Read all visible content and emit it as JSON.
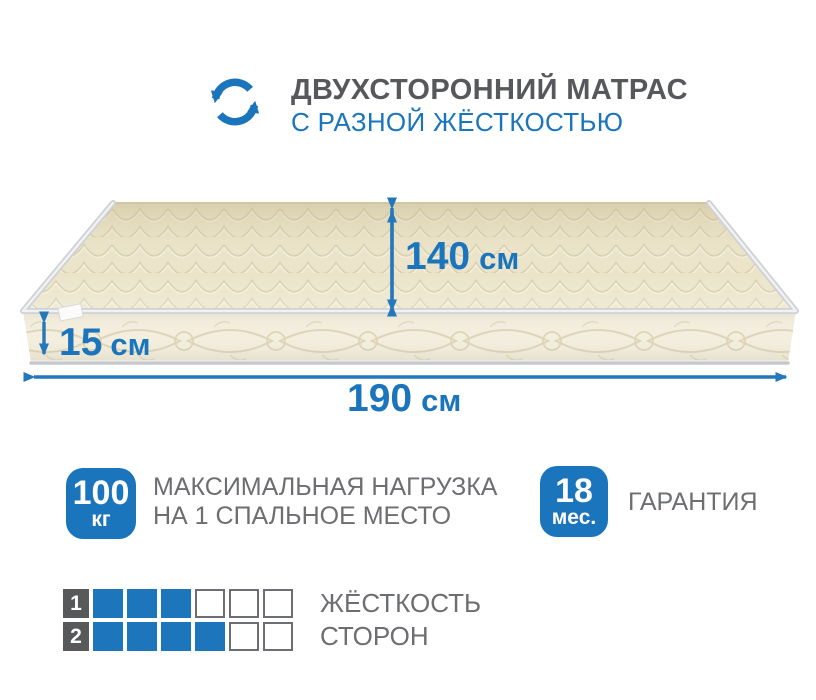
{
  "header": {
    "icon": "rotate-arrows-icon",
    "title_line1": "ДВУХСТОРОННИЙ МАТРАС",
    "title_line2": "С РАЗНОЙ ЖЁСТКОСТЬЮ"
  },
  "mattress": {
    "depth": {
      "value": "140",
      "unit": "см"
    },
    "height": {
      "value": "15",
      "unit": "см"
    },
    "length": {
      "value": "190",
      "unit": "см"
    }
  },
  "badges": {
    "max_load": {
      "value": "100",
      "unit": "кг",
      "line1": "МАКСИМАЛЬНАЯ НАГРУЗКА",
      "line2": "НА 1 СПАЛЬНОЕ МЕСТО"
    },
    "warranty": {
      "value": "18",
      "unit": "мес.",
      "line1": "ГАРАНТИЯ"
    }
  },
  "firmness": {
    "line1": "ЖЁСТКОСТЬ",
    "line2": "СТОРОН",
    "rows": [
      {
        "label": "1",
        "filled": 3,
        "total": 6
      },
      {
        "label": "2",
        "filled": 4,
        "total": 6
      }
    ]
  },
  "colors": {
    "accent_blue": "#1b75bc",
    "arrow_blue": "#2577bd",
    "dark_gray": "#58595b",
    "text_gray": "#6d6e71",
    "mattress_top": "#ebe4c9",
    "mattress_side": "#f3eedd",
    "quilt_line": "#d9d0b0",
    "piping": "#d2d4d7"
  }
}
